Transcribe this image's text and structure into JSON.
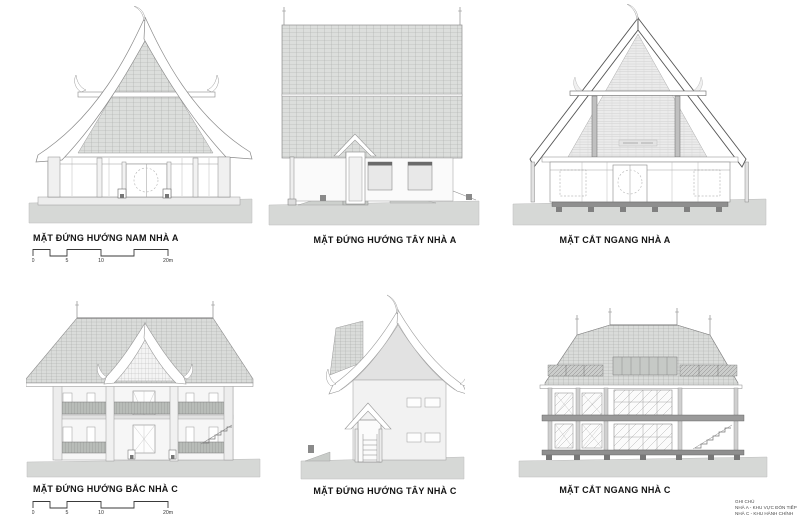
{
  "sheet": {
    "figures": [
      {
        "label": "MẶT ĐỨNG HƯỚNG NAM NHÀ A"
      },
      {
        "label": "MẶT ĐỨNG HƯỚNG TÂY NHÀ A"
      },
      {
        "label": "MẶT CẮT NGANG NHÀ A"
      },
      {
        "label": "MẶT ĐỨNG HƯỚNG BẮC NHÀ C"
      },
      {
        "label": "MẶT ĐỨNG HƯỚNG TÂY NHÀ C"
      },
      {
        "label": "MẶT CẮT NGANG NHÀ C"
      }
    ],
    "scalebar": {
      "ticks": [
        "0",
        "5",
        "10",
        "20m"
      ]
    },
    "notes": {
      "title": "GHI CHÚ",
      "lines": [
        "NHÀ A - KHU VỰC ĐÓN TIẾP",
        "NHÀ C - KHU HÀNH CHÍNH"
      ]
    },
    "colors": {
      "ground": "#d6d8d6",
      "roof_tile": "#dcdedc",
      "hatch_line": "#a8aaa8",
      "outline": "#8a8a8a",
      "dark_cut": "#555555",
      "label_text": "#141414"
    }
  }
}
